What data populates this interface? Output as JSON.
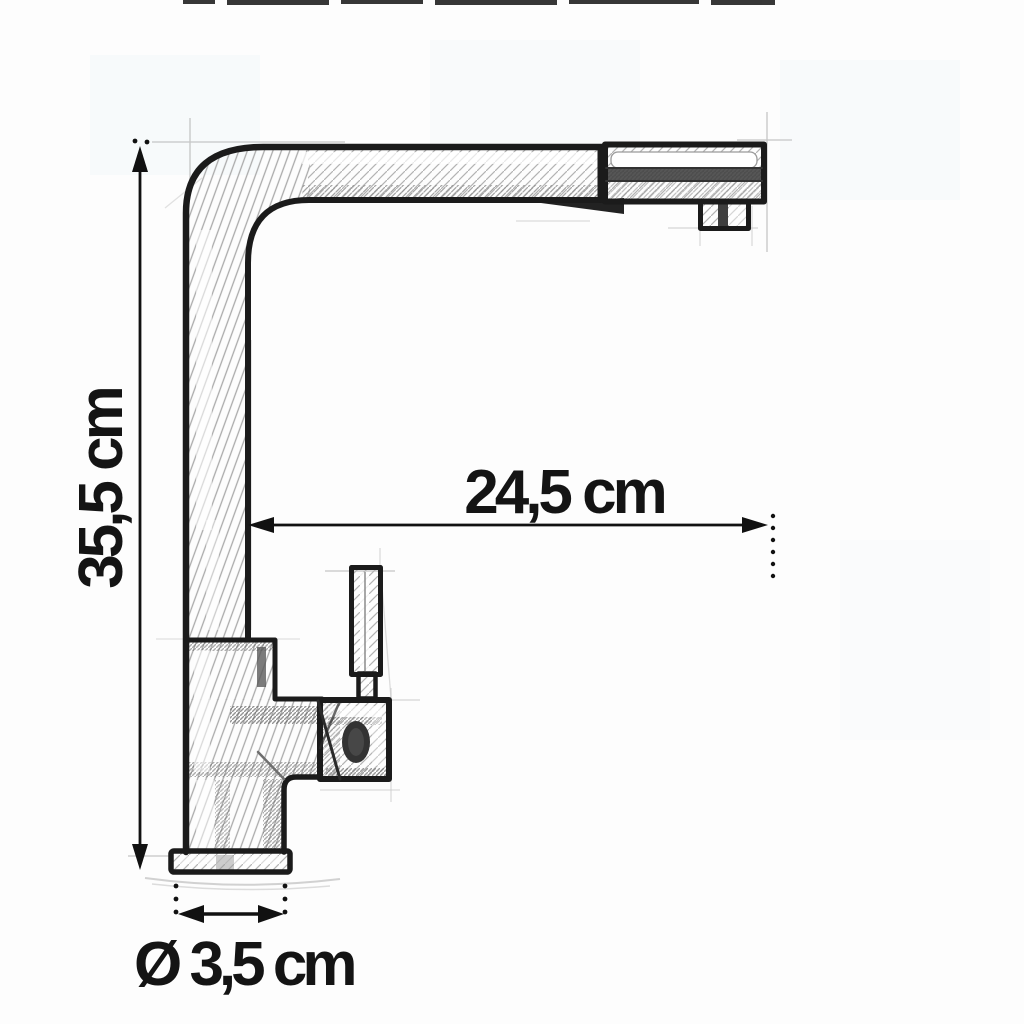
{
  "document": {
    "type": "technical-sketch",
    "subject": "kitchen faucet side view with pull-out spray head",
    "style": "pencil drawing"
  },
  "dimensions": {
    "height": {
      "label": "35,5 cm",
      "value": "35,5",
      "unit": "cm",
      "orientation": "vertical",
      "measures": "total faucet height"
    },
    "reach": {
      "label": "24,5 cm",
      "value": "24,5",
      "unit": "cm",
      "orientation": "horizontal",
      "measures": "spout reach"
    },
    "base_diameter": {
      "label": "Ø 3,5 cm",
      "value": "3,5",
      "unit": "cm",
      "orientation": "horizontal",
      "measures": "base diameter"
    }
  },
  "colors": {
    "ink": "#1a1a1a",
    "dimension_ink": "#111111",
    "pencil_hatch_light": "#b3b3b3",
    "pencil_hatch_dark": "#6a6a6a",
    "paper": "#fdfdfd",
    "head_stripe": "#4e4e4e"
  }
}
